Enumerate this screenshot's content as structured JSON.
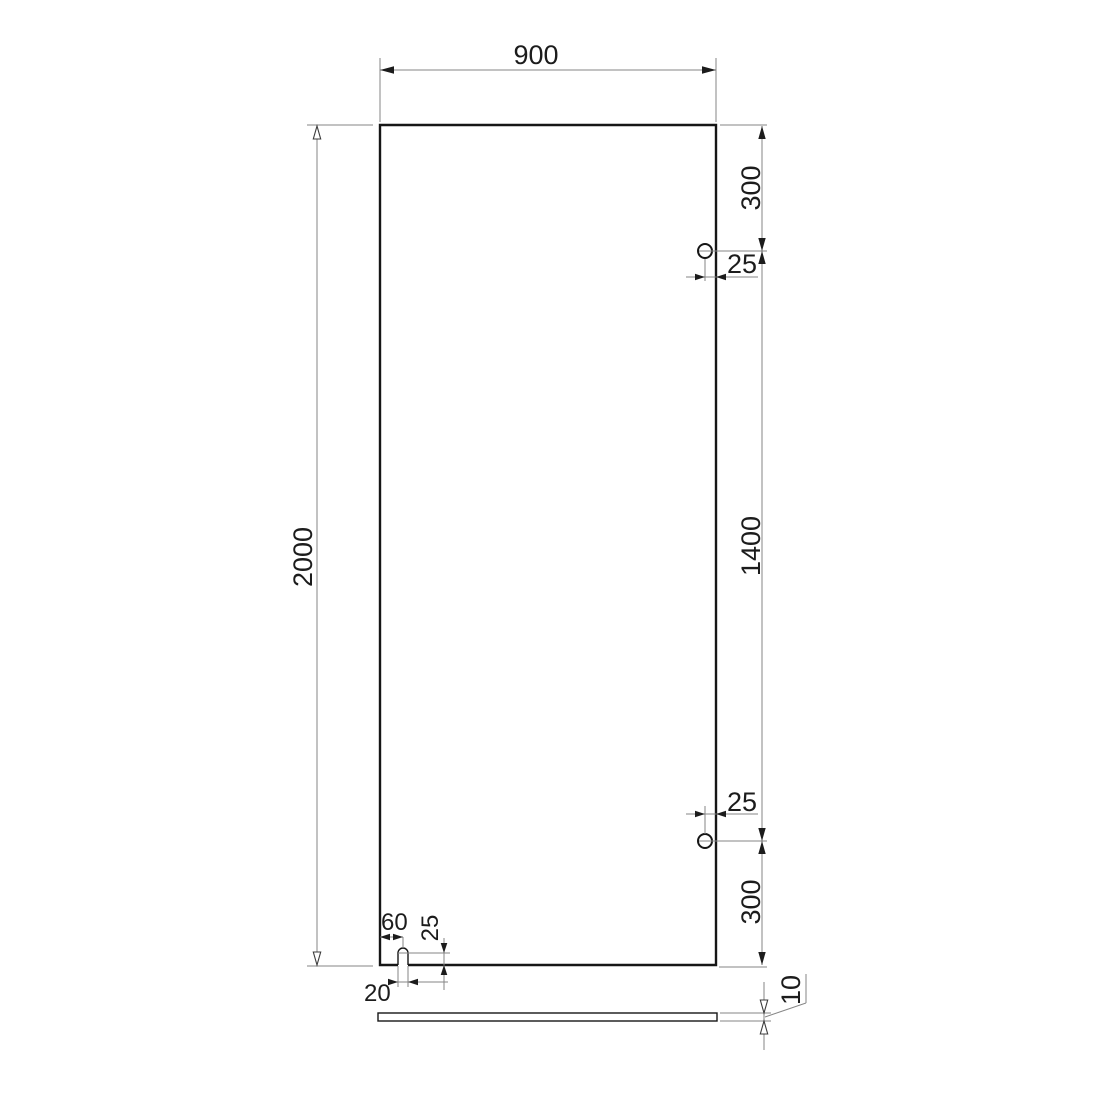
{
  "drawing": {
    "description": "Dimensioned technical drawing of a glass panel, front view and side view",
    "front_view": {
      "panel_width": "900",
      "panel_height": "2000",
      "hole_top_offset": "300",
      "hole_top_inset": "25",
      "hole_spacing": "1400",
      "hole_bottom_inset": "25",
      "hole_bottom_offset": "300",
      "slot_offset_left": "60",
      "slot_center_height": "25",
      "slot_width": "20"
    },
    "side_view": {
      "thickness": "10"
    }
  }
}
